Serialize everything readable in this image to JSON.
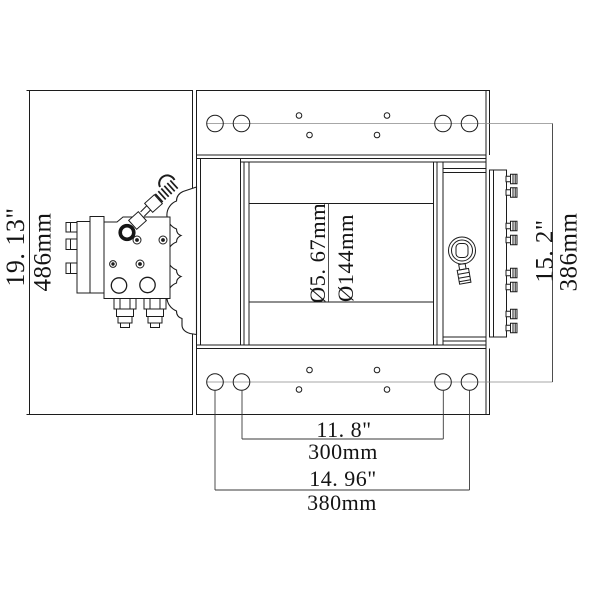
{
  "drawing": {
    "type": "technical-dimension-drawing",
    "subject": "hydraulic winch front view with mounting plates",
    "colors": {
      "background": "#ffffff",
      "line": "#1c1c1c",
      "dimension_line": "#3a3a3a",
      "centerline": "#8a8a8a",
      "text": "#141414"
    },
    "dimensions": {
      "overall_height_in": "19. 13\"",
      "overall_height_mm": "486mm",
      "drum_diameter_in": "Ø5. 67mm",
      "drum_diameter_mm": "Ø144mm",
      "mount_hole_vertical_in": "15. 2\"",
      "mount_hole_vertical_mm": "386mm",
      "mount_hole_inner_span_in": "11. 8\"",
      "mount_hole_inner_span_mm": "300mm",
      "mount_hole_outer_span_in": "14. 96\"",
      "mount_hole_outer_span_mm": "380mm"
    }
  }
}
